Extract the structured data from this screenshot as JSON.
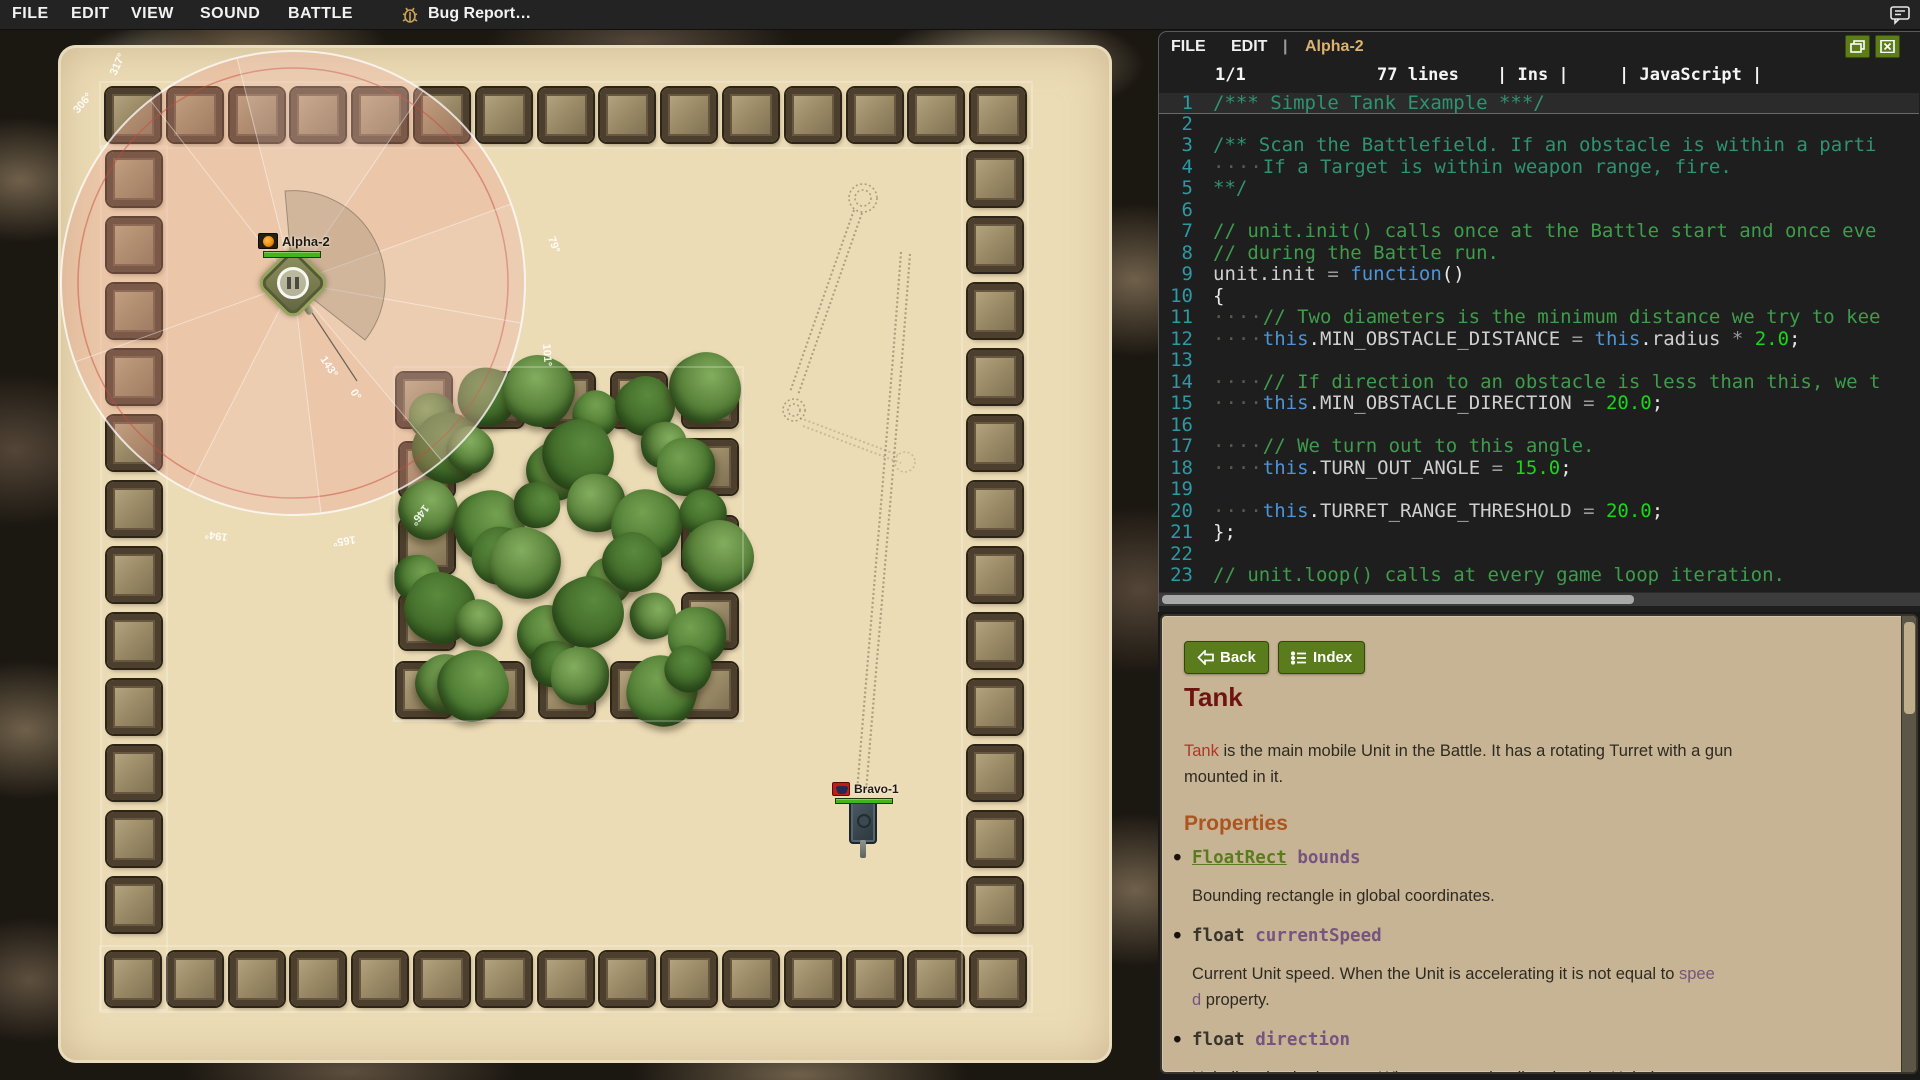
{
  "menubar": {
    "items": [
      "FILE",
      "EDIT",
      "VIEW",
      "SOUND",
      "BATTLE"
    ],
    "bug_report": "Bug Report…"
  },
  "editor": {
    "menu_items": [
      "FILE",
      "EDIT"
    ],
    "separator": "|",
    "title": "Alpha-2",
    "status": {
      "cursor": "1/1",
      "lines": "77 lines",
      "ins": "| Ins |",
      "lang": "| JavaScript |"
    },
    "code_lines": [
      {
        "n": 1,
        "current": true,
        "segs": [
          [
            "cb",
            "/*** Simple Tank Example ***/"
          ]
        ]
      },
      {
        "n": 2,
        "segs": []
      },
      {
        "n": 3,
        "segs": [
          [
            "cb",
            "/** Scan the Battlefield. If an obstacle is within a parti"
          ]
        ]
      },
      {
        "n": 4,
        "segs": [
          [
            "ws",
            "····"
          ],
          [
            "cb",
            "If a Target is within weapon range, fire."
          ]
        ]
      },
      {
        "n": 5,
        "segs": [
          [
            "cb",
            "**/"
          ]
        ]
      },
      {
        "n": 6,
        "segs": []
      },
      {
        "n": 7,
        "segs": [
          [
            "cl",
            "// unit.init() calls once at the Battle start and once eve"
          ]
        ]
      },
      {
        "n": 8,
        "segs": [
          [
            "cl",
            "// during the Battle run."
          ]
        ]
      },
      {
        "n": 9,
        "segs": [
          [
            "pl",
            "unit.init "
          ],
          [
            "op",
            "= "
          ],
          [
            "kw",
            "function"
          ],
          [
            "pu",
            "()"
          ]
        ]
      },
      {
        "n": 10,
        "segs": [
          [
            "pu",
            "{"
          ]
        ]
      },
      {
        "n": 11,
        "segs": [
          [
            "ws",
            "····"
          ],
          [
            "cl",
            "// Two diameters is the minimum distance we try to kee"
          ]
        ]
      },
      {
        "n": 12,
        "segs": [
          [
            "ws",
            "····"
          ],
          [
            "kw",
            "this"
          ],
          [
            "pu",
            "."
          ],
          [
            "pl",
            "MIN_OBSTACLE_DISTANCE"
          ],
          [
            "op",
            " = "
          ],
          [
            "kw",
            "this"
          ],
          [
            "pu",
            "."
          ],
          [
            "pl",
            "radius"
          ],
          [
            "op",
            " * "
          ],
          [
            "num",
            "2.0"
          ],
          [
            "pu",
            ";"
          ]
        ]
      },
      {
        "n": 13,
        "segs": []
      },
      {
        "n": 14,
        "segs": [
          [
            "ws",
            "····"
          ],
          [
            "cl",
            "// If direction to an obstacle is less than this, we t"
          ]
        ]
      },
      {
        "n": 15,
        "segs": [
          [
            "ws",
            "····"
          ],
          [
            "kw",
            "this"
          ],
          [
            "pu",
            "."
          ],
          [
            "pl",
            "MIN_OBSTACLE_DIRECTION"
          ],
          [
            "op",
            " = "
          ],
          [
            "num",
            "20.0"
          ],
          [
            "pu",
            ";"
          ]
        ]
      },
      {
        "n": 16,
        "segs": []
      },
      {
        "n": 17,
        "segs": [
          [
            "ws",
            "····"
          ],
          [
            "cl",
            "// We turn out to this angle."
          ]
        ]
      },
      {
        "n": 18,
        "segs": [
          [
            "ws",
            "····"
          ],
          [
            "kw",
            "this"
          ],
          [
            "pu",
            "."
          ],
          [
            "pl",
            "TURN_OUT_ANGLE"
          ],
          [
            "op",
            " = "
          ],
          [
            "num",
            "15.0"
          ],
          [
            "pu",
            ";"
          ]
        ]
      },
      {
        "n": 19,
        "segs": []
      },
      {
        "n": 20,
        "segs": [
          [
            "ws",
            "····"
          ],
          [
            "kw",
            "this"
          ],
          [
            "pu",
            "."
          ],
          [
            "pl",
            "TURRET_RANGE_THRESHOLD"
          ],
          [
            "op",
            " = "
          ],
          [
            "num",
            "20.0"
          ],
          [
            "pu",
            ";"
          ]
        ]
      },
      {
        "n": 21,
        "segs": [
          [
            "pu",
            "};"
          ]
        ]
      },
      {
        "n": 22,
        "segs": []
      },
      {
        "n": 23,
        "segs": [
          [
            "cl",
            "// unit.loop() calls at every game loop iteration."
          ]
        ]
      }
    ]
  },
  "docs": {
    "back": "Back",
    "index": "Index",
    "title": "Tank",
    "intro": [
      [
        "link-red",
        "Tank"
      ],
      [
        "t",
        " is the main mobile Unit in the Battle. It has a rotating Turret with a gun"
      ],
      [
        "br",
        ""
      ],
      [
        "t",
        "mounted in it."
      ]
    ],
    "properties_heading": "Properties",
    "properties": [
      {
        "type": "FloatRect",
        "type_class": "link-green",
        "name": "bounds",
        "desc": [
          [
            "t",
            "Bounding rectangle in global coordinates."
          ]
        ]
      },
      {
        "type": "float",
        "type_class": "kwtype",
        "name": "currentSpeed",
        "desc": [
          [
            "t",
            "Current Unit speed. When the Unit is accelerating it is not equal to "
          ],
          [
            "link-purple",
            "spee"
          ],
          [
            "br",
            ""
          ],
          [
            "link-purple",
            "d"
          ],
          [
            "t",
            " property."
          ]
        ]
      },
      {
        "type": "float",
        "type_class": "kwtype",
        "name": "direction",
        "desc": [
          [
            "t",
            "Unit direction in degrees. When you set the direction, the Unit does not"
          ]
        ]
      }
    ]
  },
  "map": {
    "units": [
      {
        "name": "Alpha-2",
        "health_color": "#44b31c"
      },
      {
        "name": "Bravo-1",
        "health_color": "#44b31c"
      }
    ],
    "radar_labels": [
      "306°",
      "317°",
      "79°",
      "101°",
      "146°",
      "165°",
      "194°",
      "143°",
      "0°"
    ]
  },
  "colors": {
    "accent_green": "#5d7d18",
    "doc_background": "#c7b494",
    "sand": "#ecdcb6",
    "health_green": "#44b31c",
    "editor_background": "#1e1e1e",
    "doc_title_red": "#6e1410",
    "properties_orange": "#ad5520"
  }
}
